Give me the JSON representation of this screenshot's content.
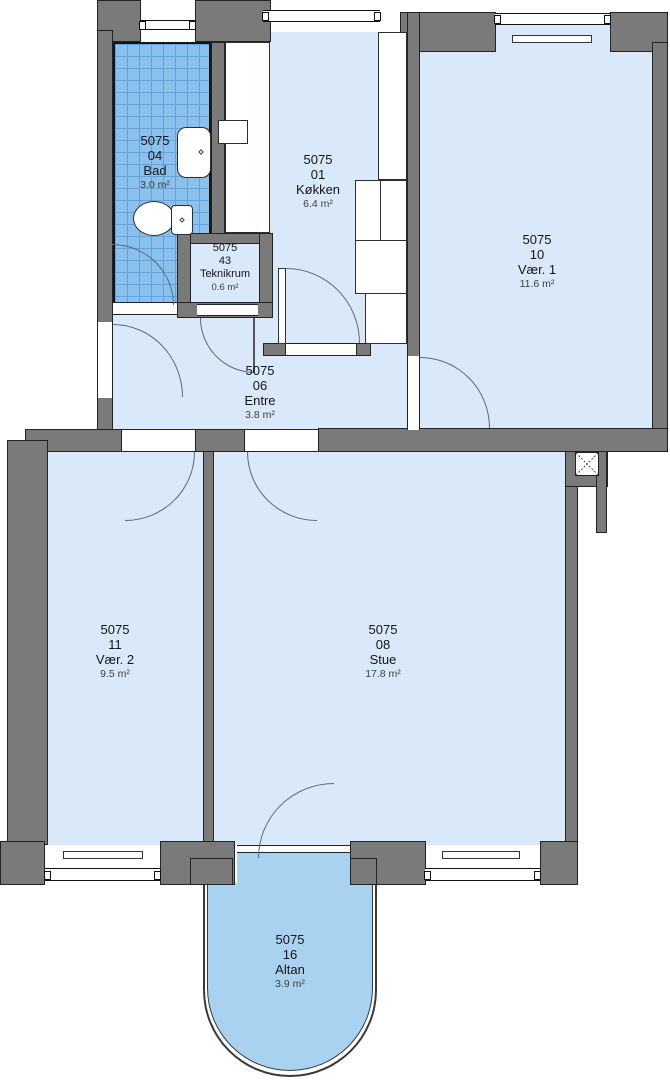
{
  "plan": {
    "title": "Apartment floor plan 5075",
    "unit": "5075",
    "rooms": [
      {
        "unit": "5075",
        "number": "04",
        "name": "Bad",
        "area": "3.0 m²"
      },
      {
        "unit": "5075",
        "number": "01",
        "name": "Køkken",
        "area": "6.4 m²"
      },
      {
        "unit": "5075",
        "number": "10",
        "name": "Vær. 1",
        "area": "11.6 m²"
      },
      {
        "unit": "5075",
        "number": "43",
        "name": "Teknikrum",
        "area": "0.6 m²"
      },
      {
        "unit": "5075",
        "number": "06",
        "name": "Entre",
        "area": "3.8 m²"
      },
      {
        "unit": "5075",
        "number": "11",
        "name": "Vær. 2",
        "area": "9.5 m²"
      },
      {
        "unit": "5075",
        "number": "08",
        "name": "Stue",
        "area": "17.8 m²"
      },
      {
        "unit": "5075",
        "number": "16",
        "name": "Altan",
        "area": "3.9 m²"
      }
    ],
    "colors": {
      "wall": "#7a7a7a",
      "room_floor": "#d9e9fa",
      "bath_tile": "#8cc1ee",
      "balcony": "#a9d2f1",
      "outline": "#232323"
    }
  }
}
